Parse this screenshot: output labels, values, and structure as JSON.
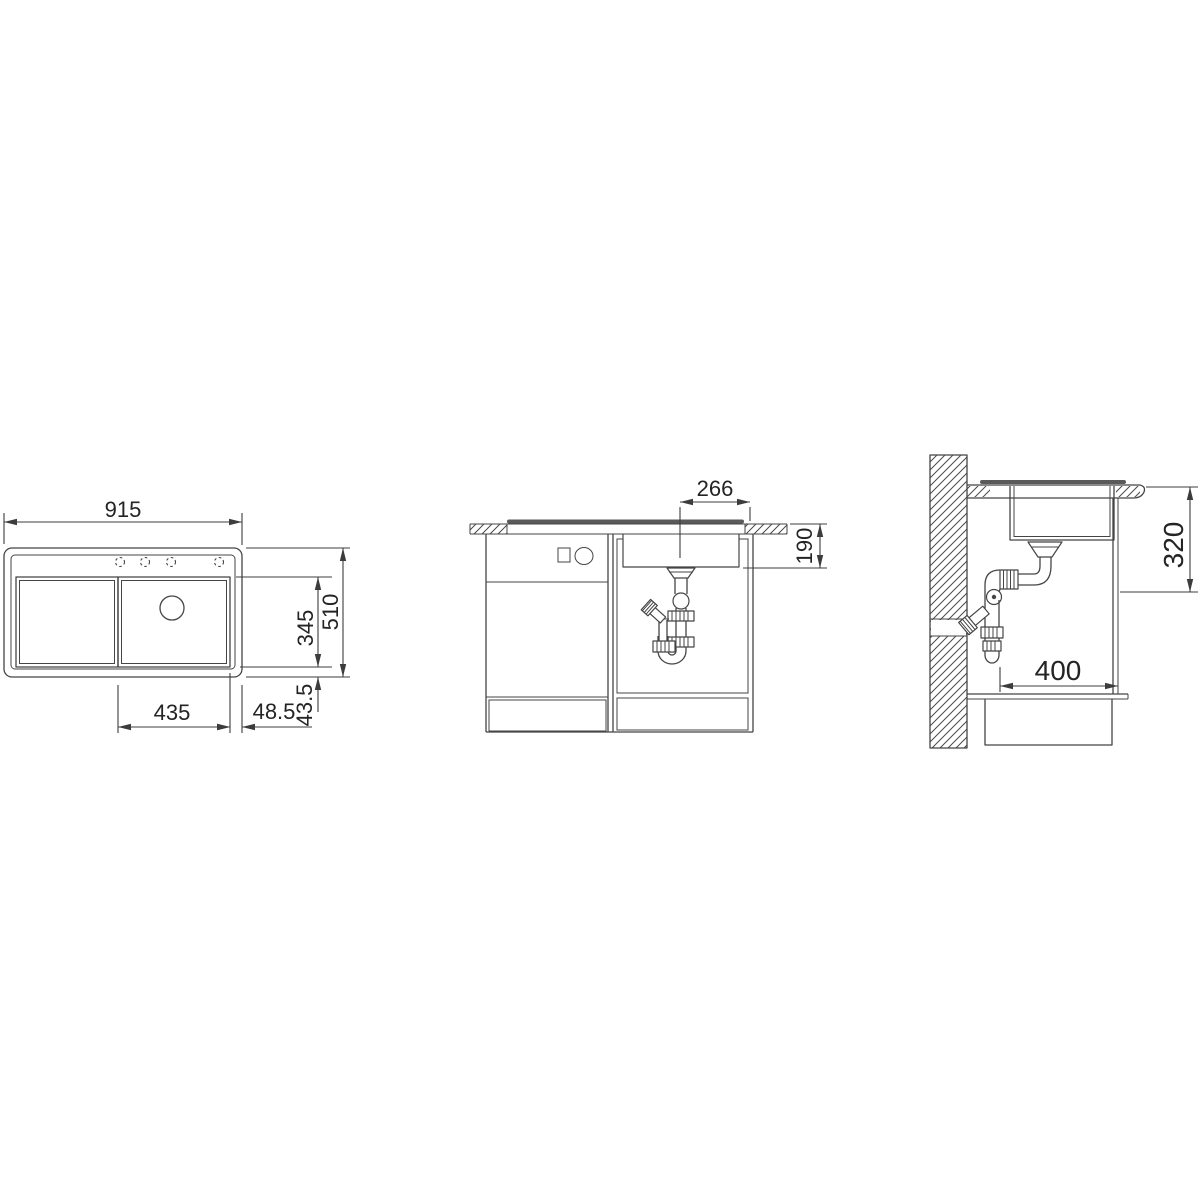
{
  "page": {
    "background": "#ffffff"
  },
  "style": {
    "line_color": "#454545",
    "dim_color": "#3c3c3c",
    "text_color": "#242424",
    "flange_color": "#5a5a5a"
  },
  "views": {
    "top": {
      "dims": {
        "total_width": "915",
        "total_depth": "510",
        "bowl_depth": "345",
        "bowl_width": "435",
        "right_offset": "48.5",
        "bottom_offset": "43.5"
      }
    },
    "front": {
      "dims": {
        "drain_to_edge": "266",
        "bowl_height": "190"
      }
    },
    "side": {
      "dims": {
        "height_below_top": "320",
        "drain_distance": "400"
      }
    }
  }
}
